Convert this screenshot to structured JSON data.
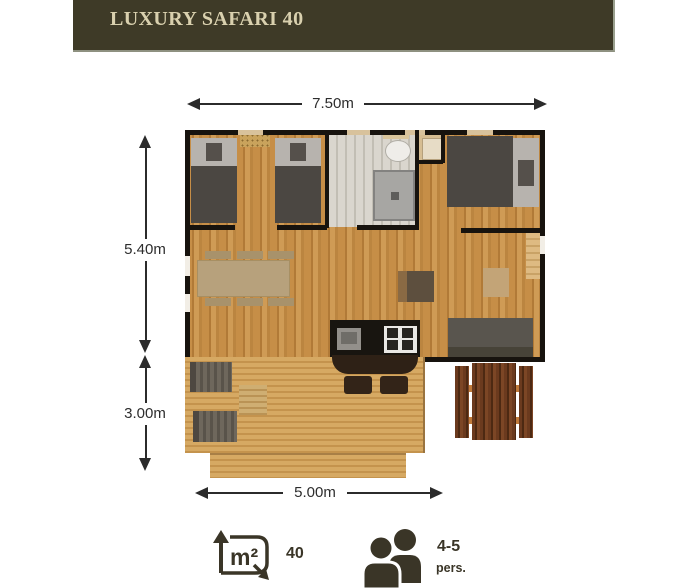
{
  "header": {
    "title": "LUXURY SAFARI 40"
  },
  "dimensions": {
    "top_width": "7.50m",
    "main_depth": "5.40m",
    "terrace_depth": "3.00m",
    "terrace_width": "5.00m"
  },
  "stats": {
    "area": {
      "value": "40",
      "unit": "m²"
    },
    "capacity": {
      "value": "4-5",
      "unit": "pers."
    }
  },
  "icons": {
    "area_icon": "square-meters-icon",
    "capacity_icon": "people-icon"
  },
  "colors": {
    "header_bg": "#3e3a27",
    "header_text": "#d9d0ae",
    "icon": "#3a3527",
    "wall": "#17130e",
    "dim": "#2b2b2b",
    "floor_wood": "#c68e47",
    "deck_wood": "#d6a963",
    "picnic_wood": "#5b3018"
  }
}
